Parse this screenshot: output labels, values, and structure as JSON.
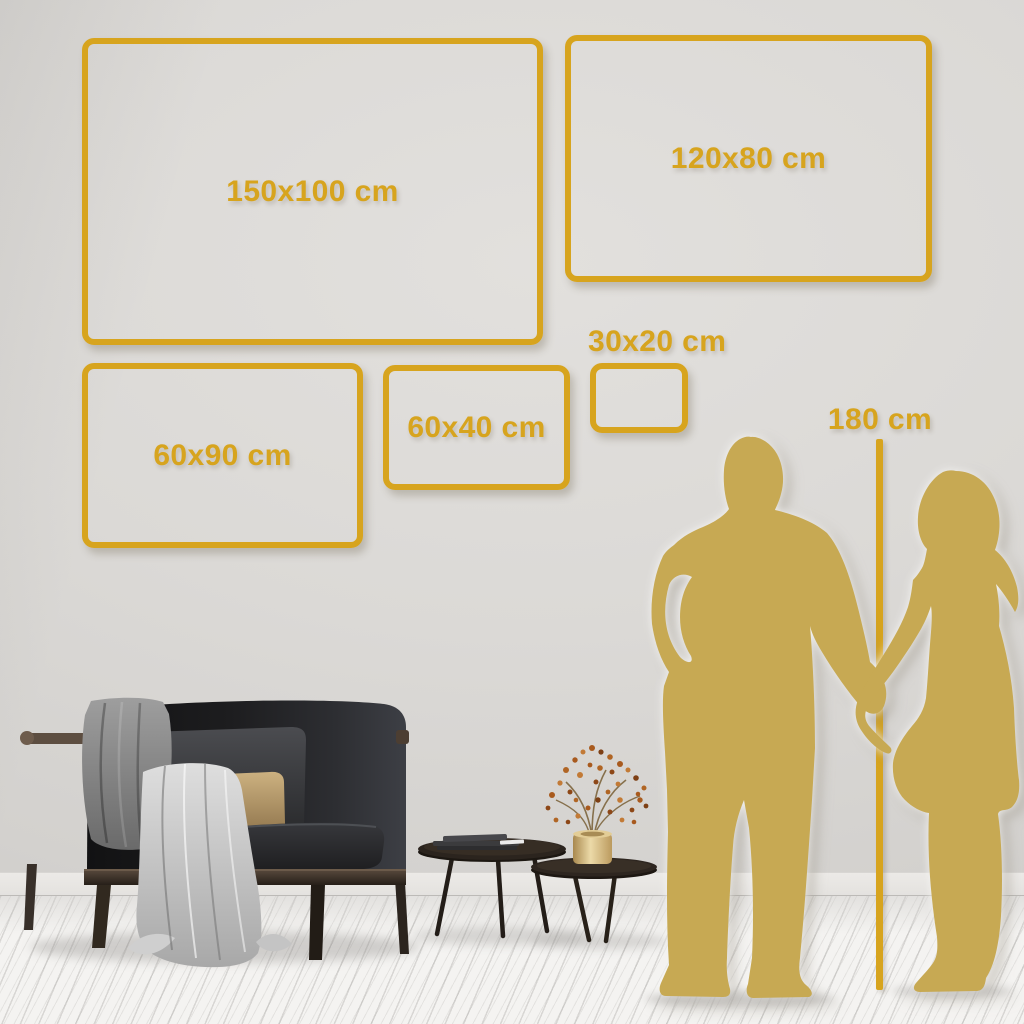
{
  "frames": [
    {
      "label": "150x100 cm"
    },
    {
      "label": "120x80 cm"
    },
    {
      "label": "60x90 cm"
    },
    {
      "label": "60x40 cm"
    },
    {
      "label": "30x20 cm"
    }
  ],
  "height_marker": {
    "label": "180 cm"
  },
  "colors": {
    "accent_gold": "#d7a41e",
    "silhouette_gold": "#c7a953",
    "wall_gray": "#d9d7d4",
    "floor_white": "#f4f3f1",
    "sofa_charcoal": "#1f1f21",
    "wood_brown": "#4b3e33",
    "pillow_tan": "#c2a06b",
    "blanket_gray": "#8f8f8f",
    "vase_gold": "#d9c187"
  }
}
